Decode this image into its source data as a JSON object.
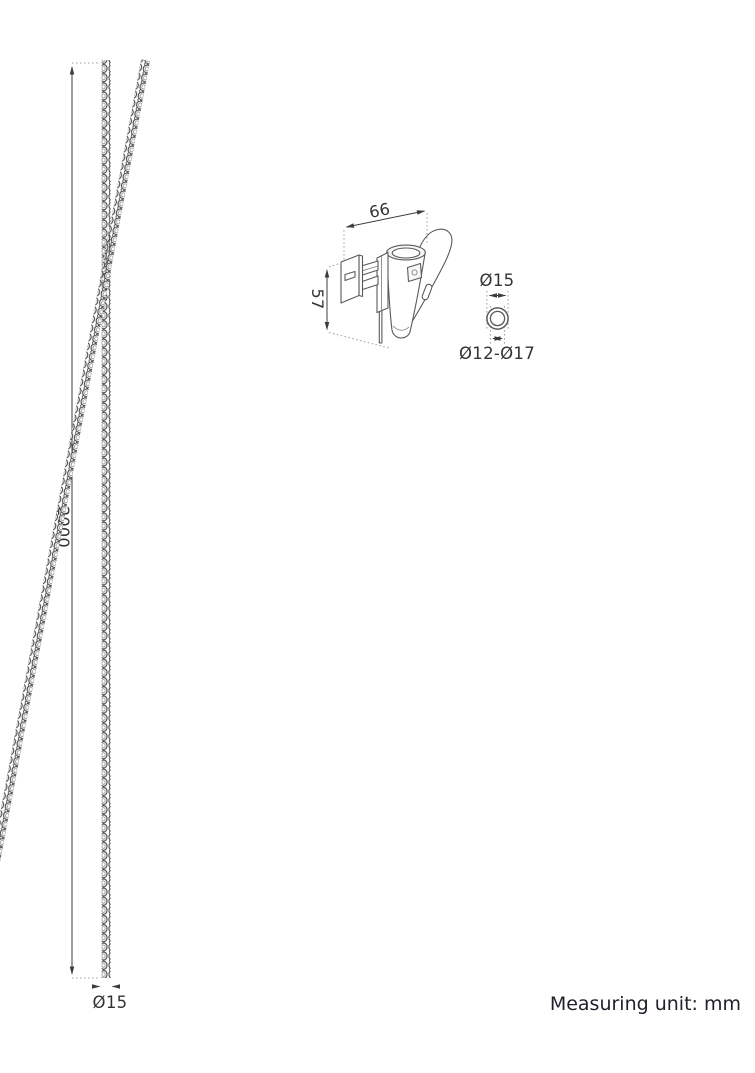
{
  "drawing": {
    "unit_note": "Measuring unit: mm",
    "pole": {
      "length_label": "2000",
      "diameter_label": "Ø15"
    },
    "bracket": {
      "width_label": "66",
      "height_label": "57"
    },
    "ring_detail": {
      "outer_diameter_label": "Ø15",
      "fit_range_label": "Ø12-Ø17"
    },
    "colors": {
      "outline": "#5a5a5a",
      "dimension_line": "#3c3c3c",
      "dotted_extension": "#a3a3a3",
      "label_text": "#333333",
      "note_text": "#20222b",
      "background": "#ffffff"
    }
  }
}
